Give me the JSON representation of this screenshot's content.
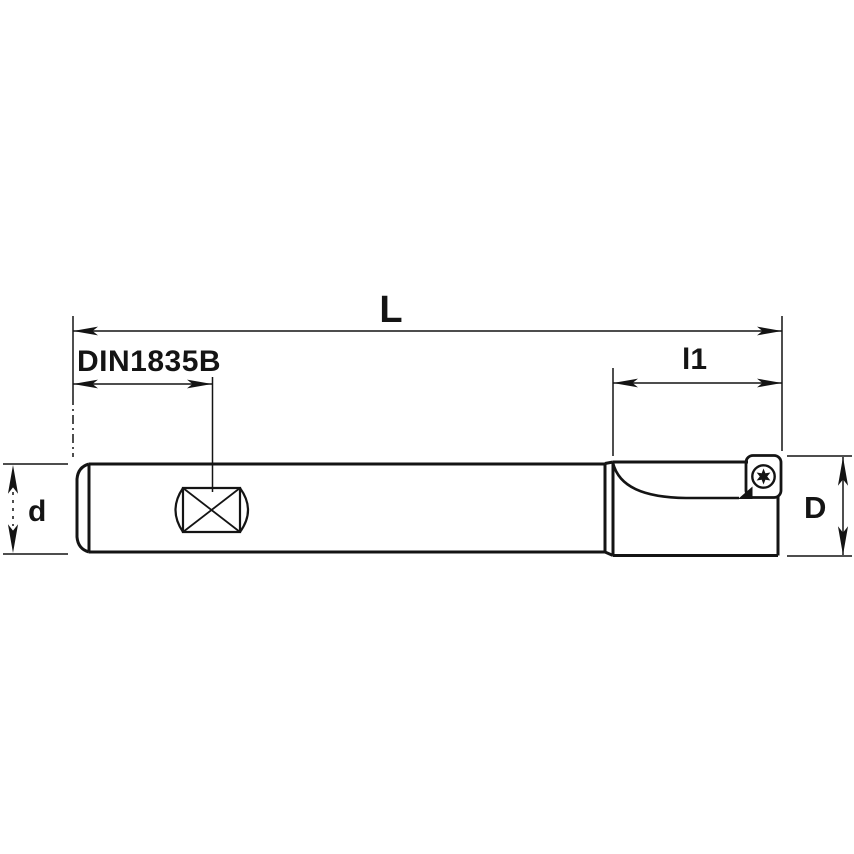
{
  "drawing": {
    "type": "technical-dimension-drawing",
    "subject": "indexable end milling cutter with cylindrical shank, side view",
    "labels": {
      "overall_length": "L",
      "shank_standard": "DIN1835B",
      "head_length": "l1",
      "shank_diameter": "d",
      "cutting_diameter": "D"
    },
    "icons": {
      "insert_screw": "torx-screw-icon",
      "shank_flat": "weldon-flat-crossed-symbol"
    },
    "colors": {
      "background": "#ffffff",
      "line": "#141414"
    }
  }
}
